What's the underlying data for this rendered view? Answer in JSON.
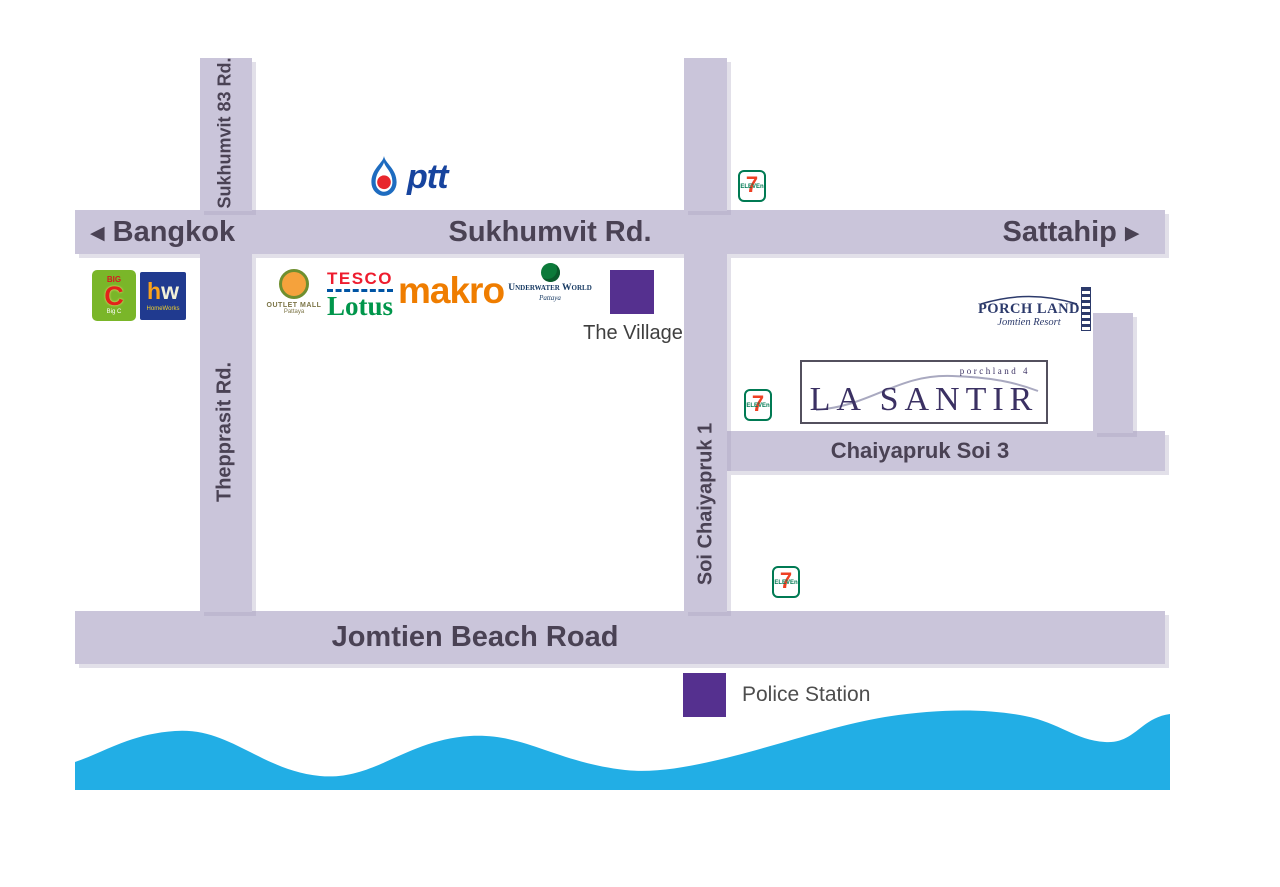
{
  "title": "La Santir Pattaya location map",
  "colors": {
    "road": "#cac5da",
    "road_text": "#4a4254",
    "marker_purple": "#55308f",
    "sea_blue": "#22aee5",
    "ptt_blue": "#17449e",
    "seven_eleven_green": "#007a53",
    "seven_eleven_orange": "#ee4023",
    "tesco_red": "#ee1c2e",
    "lotus_green": "#00964b",
    "makro_orange": "#ef7d00",
    "big_c_green": "#7ab629",
    "homeworks_navy": "#203a8f",
    "la_santir_ink": "#3b3163",
    "porch_land_navy": "#2c3a6b"
  },
  "roads": {
    "sukhumvit": {
      "name": "Sukhumvit Rd.",
      "west_arrow": "◀",
      "west_label": "Bangkok",
      "east_label": "Sattahip",
      "east_arrow": "▶"
    },
    "sukhumvit_83": {
      "name": "Sukhumvit 83 Rd."
    },
    "thepprasit": {
      "name": "Thepprasit Rd."
    },
    "soi_chaiyapruk_1": {
      "name": "Soi Chaiyapruk 1"
    },
    "chaiyapruk_soi_3": {
      "name": "Chaiyapruk Soi 3"
    },
    "jomtien_beach": {
      "name": "Jomtien Beach Road"
    }
  },
  "landmarks": {
    "ptt": {
      "name": "ptt"
    },
    "seven_eleven": {
      "digit": "7",
      "word": "ELEVEn"
    },
    "big_c": {
      "top": "BIG",
      "letter": "C",
      "bottom": "Big C"
    },
    "homeworks": {
      "h": "h",
      "w": "w",
      "sub": "HomeWorks"
    },
    "outlet_mall": {
      "line1": "OUTLET MALL",
      "line2": "Pattaya"
    },
    "tesco_lotus": {
      "line1": "TESCO",
      "line2": "Lotus"
    },
    "makro": {
      "name": "makro"
    },
    "underwater_world": {
      "line1": "Underwater World",
      "line2": "Pattaya"
    },
    "the_village": {
      "name": "The Village"
    },
    "porch_land": {
      "line1": "PORCH LAND",
      "line2": "Jomtien Resort"
    },
    "la_santir": {
      "tagline": "porchland 4",
      "name": "LA SANTIR"
    },
    "police_station": {
      "name": "Police Station"
    }
  }
}
